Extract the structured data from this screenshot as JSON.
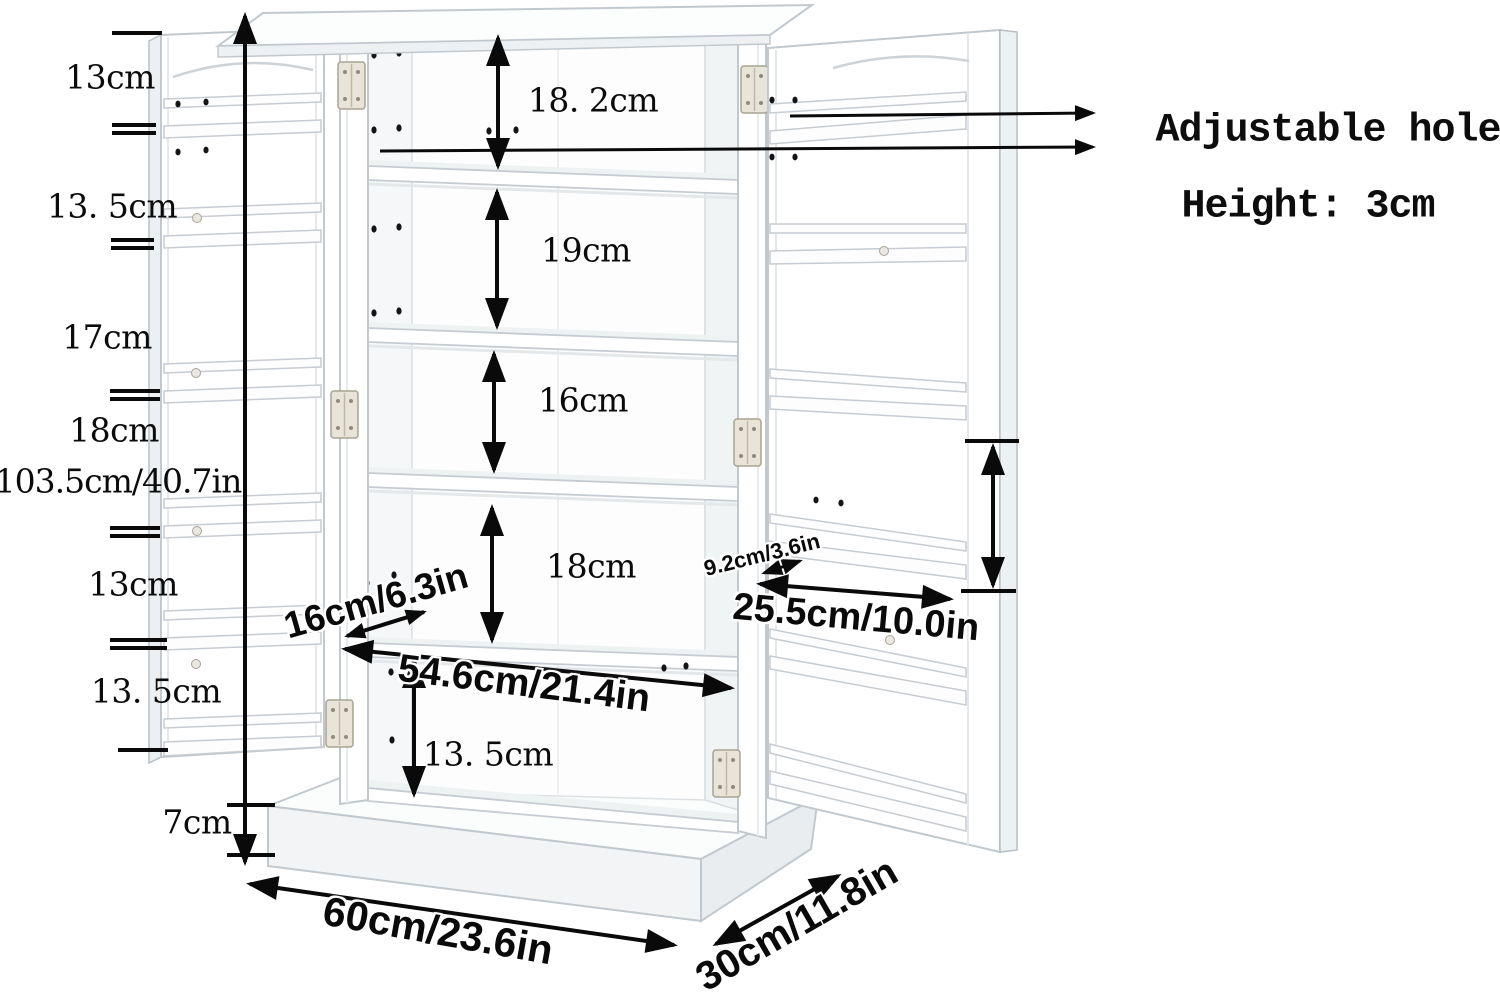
{
  "diagram": {
    "callout": {
      "line1": "Adjustable hole",
      "line2": "Height: 3cm"
    },
    "left": {
      "s1": "13cm",
      "s2": "13. 5cm",
      "s3": "17cm",
      "s4": "18cm",
      "overall_height": "103.5cm/40.7in",
      "s5": "13cm",
      "s6": "13. 5cm",
      "base_height": "7cm"
    },
    "interior": {
      "sec1": "18. 2cm",
      "sec2": "19cm",
      "sec3": "16cm",
      "sec4": "18cm",
      "sec5": "13. 5cm",
      "width": "54.6cm/21.4in"
    },
    "doors": {
      "left_shelf_depth": "16cm/6.3in",
      "right_shelf_depth": "9.2cm/3.6in",
      "right_door_width": "25.5cm/10.0in"
    },
    "overall": {
      "width": "60cm/23.6in",
      "depth": "30cm/11.8in"
    },
    "colors": {
      "line": "#0a0a0a",
      "cabinet_outline": "#c2c9ce",
      "background": "#ffffff"
    }
  }
}
